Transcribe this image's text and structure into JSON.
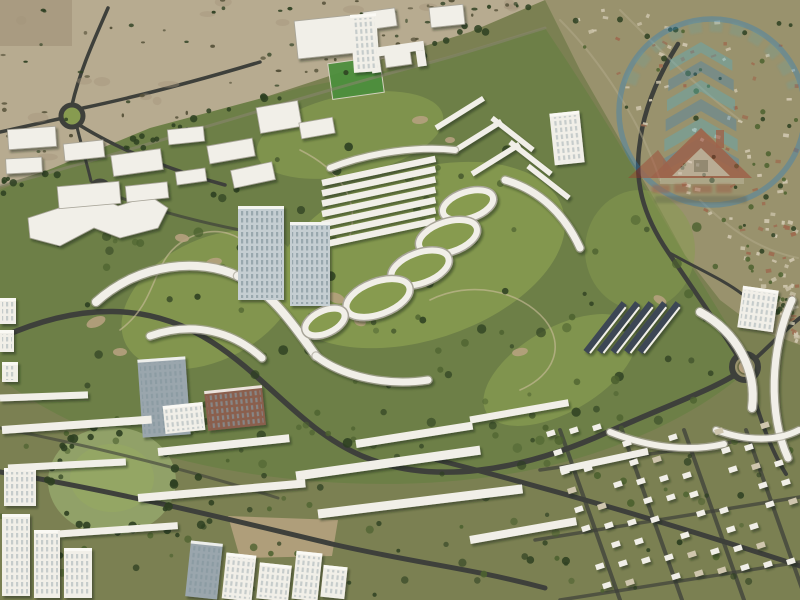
{
  "meta": {
    "title": "Aerial master-plan render",
    "description": "Aerial 3D rendering of a golf-course master-planned residential community: desert at top-left, low-rise villa district at top-right, central golf fairways lined with curved white apartment rows, oval building clusters, mid-rise towers, townhouse rows and villa grids at the bottom, three roundabouts, and a semi-transparent circular real-estate watermark badge in the top-right corner."
  },
  "palette": {
    "baseOlive": "#7b8052",
    "sand": "#b7ab90",
    "sandShadow": "#a2947a",
    "khaki": "#99926d",
    "golfMid": "#6d7f47",
    "golfLight": "#879b50",
    "golfBright": "#9cae5f",
    "parkGreen": "#91a168",
    "fieldGreen": "#4d8f3d",
    "dirt": "#b5a17e",
    "treeDark": "#2d3f21",
    "treeMid": "#4c612f",
    "shrub": "#514d35",
    "road": "#3e403b",
    "roadMinor": "#8a8571",
    "cartPath": "#c6ba97",
    "building": "#f1efe8",
    "buildingShade": "#a8a599",
    "towerGlass": "#c5ced2",
    "towerDark": "#9aa6ad",
    "towerStripe": "#86979f",
    "roofDark": "#3d4654",
    "brick": "#8a5f4d",
    "terracotta": "#9d6c50",
    "villaTan": "#cfc6ae",
    "logoBlue": "#2f7fc1",
    "logoTeal": "#41b4d8",
    "logoRed": "#a33429",
    "logoWhite": "#e9e4d9"
  },
  "watermark": {
    "type": "circular real-estate agency badge",
    "ring": "blue circle outline",
    "arc_text": "illegible arc lettering",
    "chevrons": "stacked blue-teal upward chevrons",
    "house": "gabled house with red roof and chimney",
    "script": "illegible red script text",
    "opacity": 0.48
  },
  "regions": {
    "top_left": "desert with scattered shrubs",
    "top_right": "low-rise villa district",
    "center": "golf fairways with curved apartment rows and oval clusters",
    "left": "warehouses and golf clubhouse",
    "bottom": "townhouse rows, villa grid, high-rise clusters"
  }
}
